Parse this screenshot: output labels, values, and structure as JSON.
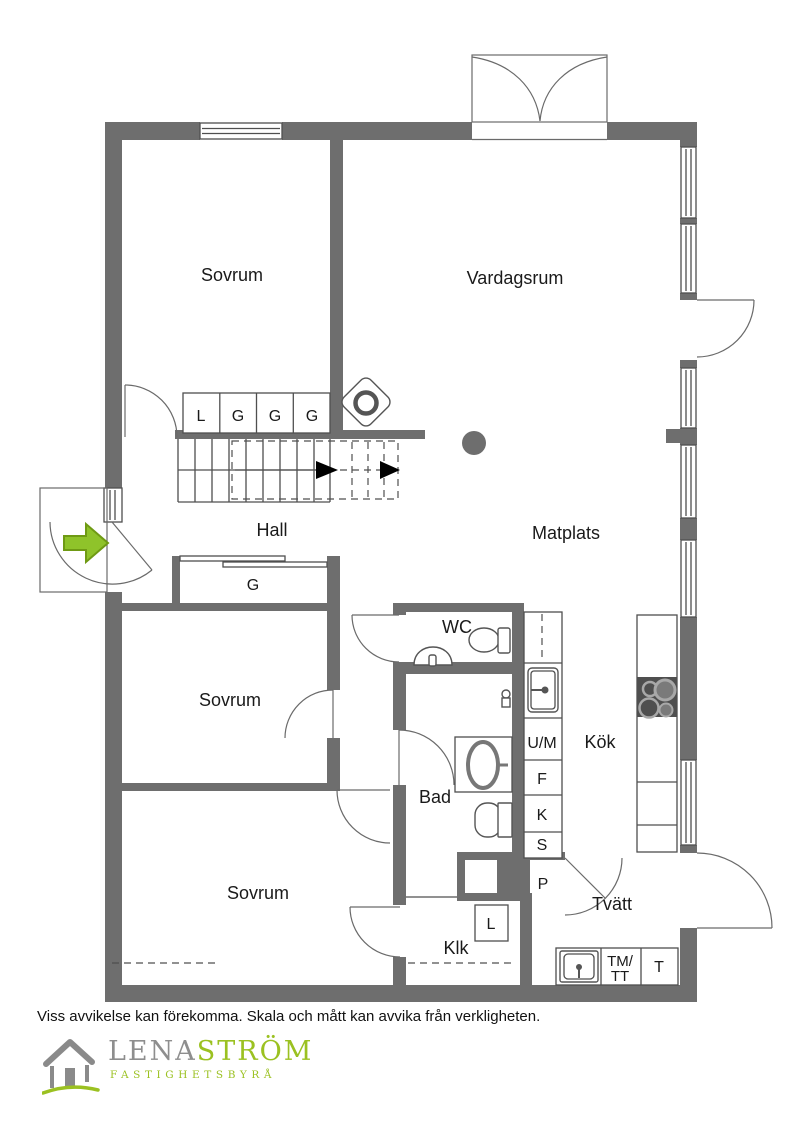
{
  "plan": {
    "rooms": {
      "sovrum_top": "Sovrum",
      "vardagsrum": "Vardagsrum",
      "hall": "Hall",
      "matplats": "Matplats",
      "sovrum_mid": "Sovrum",
      "kok": "Kök",
      "wc": "WC",
      "bad": "Bad",
      "sovrum_bottom": "Sovrum",
      "tvatt": "Tvätt",
      "klk": "Klk"
    },
    "closets": {
      "linen": "L",
      "g1": "G",
      "g2": "G",
      "g3": "G",
      "hall_closet": "G"
    },
    "kitchen_units": {
      "dishwasher": "U/M",
      "freezer": "F",
      "fridge": "K",
      "pantry": "S"
    },
    "utility": {
      "p": "P",
      "l": "L",
      "washer_line1": "TM/",
      "washer_line2": "TT",
      "dryer": "T"
    }
  },
  "footer": {
    "disclaimer": "Viss avvikelse kan förekomma. Skala och mått kan avvika från verkligheten.",
    "logo": {
      "brand_gray": "LENA",
      "brand_green": "STRÖM",
      "tagline": "FASTIGHETSBYRÅ"
    }
  },
  "colors": {
    "wall": "#6e6e6e",
    "logo_green": "#9bc121",
    "arrow_green": "#8fc32a"
  }
}
